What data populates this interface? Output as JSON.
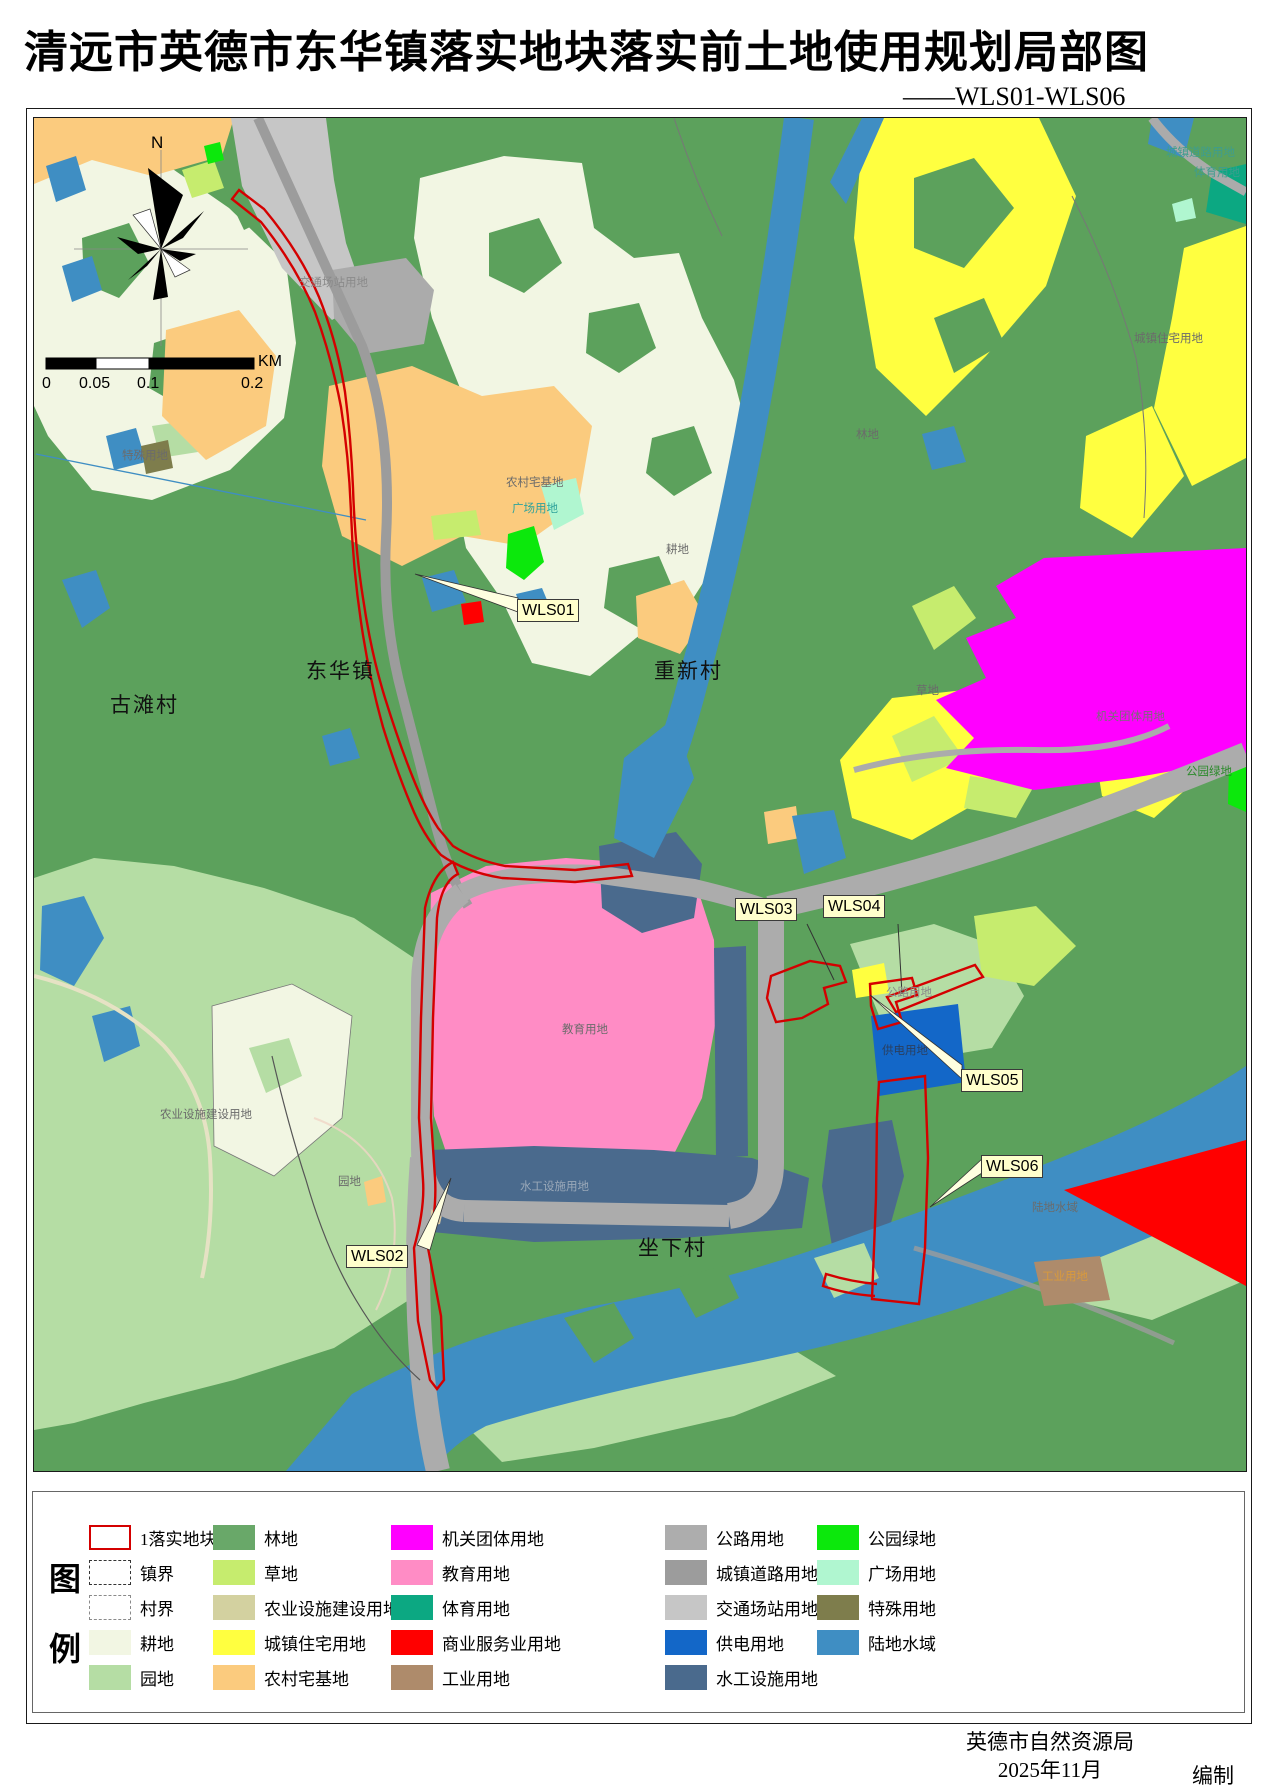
{
  "title": "清远市英德市东华镇落实地块落实前土地使用规划局部图",
  "subtitle": "——WLS01-WLS06",
  "compass": {
    "north": "N"
  },
  "scalebar": {
    "ticks": [
      "0",
      "0.05",
      "0.1",
      "0.2"
    ],
    "unit": "KM"
  },
  "map": {
    "places": [
      {
        "name": "东华镇"
      },
      {
        "name": "重新村"
      },
      {
        "name": "古滩村"
      },
      {
        "name": "坐下村"
      }
    ],
    "landuse_labels": [
      {
        "text": "交通场站用地"
      },
      {
        "text": "城镇道路用地"
      },
      {
        "text": "体育用地"
      },
      {
        "text": "城镇住宅用地"
      },
      {
        "text": "林地"
      },
      {
        "text": "特殊用地"
      },
      {
        "text": "农村宅基地"
      },
      {
        "text": "广场用地"
      },
      {
        "text": "耕地"
      },
      {
        "text": "草地"
      },
      {
        "text": "机关团体用地"
      },
      {
        "text": "公园绿地"
      },
      {
        "text": "公路用地"
      },
      {
        "text": "供电用地"
      },
      {
        "text": "教育用地"
      },
      {
        "text": "农业设施建设用地"
      },
      {
        "text": "园地"
      },
      {
        "text": "水工设施用地"
      },
      {
        "text": "陆地水域"
      },
      {
        "text": "工业用地"
      }
    ],
    "parcel_labels": [
      {
        "text": "WLS01"
      },
      {
        "text": "WLS02"
      },
      {
        "text": "WLS03"
      },
      {
        "text": "WLS04"
      },
      {
        "text": "WLS05"
      },
      {
        "text": "WLS06"
      }
    ]
  },
  "legend": {
    "heading": {
      "line1": "图",
      "line2": "例"
    },
    "col1": [
      {
        "label": "1落实地块",
        "type": "parcel-outline"
      },
      {
        "label": "镇界",
        "type": "town-boundary"
      },
      {
        "label": "村界",
        "type": "village-boundary"
      },
      {
        "label": "耕地",
        "color": "#F2F6E3"
      },
      {
        "label": "园地",
        "color": "#B5DDA4"
      }
    ],
    "col2": [
      {
        "label": "林地",
        "color": "#69A869"
      },
      {
        "label": "草地",
        "color": "#C6EC6E"
      },
      {
        "label": "农业设施建设用地",
        "color": "#D3D1A0"
      },
      {
        "label": "城镇住宅用地",
        "color": "#FFFF40"
      },
      {
        "label": "农村宅基地",
        "color": "#FBCB7E"
      }
    ],
    "col3": [
      {
        "label": "机关团体用地",
        "color": "#FF00FF"
      },
      {
        "label": "教育用地",
        "color": "#FF8CC5"
      },
      {
        "label": "体育用地",
        "color": "#0CA882"
      },
      {
        "label": "商业服务业用地",
        "color": "#FF0000"
      },
      {
        "label": "工业用地",
        "color": "#AE8B6B"
      }
    ],
    "col4": [
      {
        "label": "公路用地",
        "color": "#ADADAD"
      },
      {
        "label": "城镇道路用地",
        "color": "#9C9C9C"
      },
      {
        "label": "交通场站用地",
        "color": "#C6C6C6"
      },
      {
        "label": "供电用地",
        "color": "#1367C8"
      },
      {
        "label": "水工设施用地",
        "color": "#4A6A8D"
      }
    ],
    "col5": [
      {
        "label": "公园绿地",
        "color": "#0CE80C"
      },
      {
        "label": "广场用地",
        "color": "#B0F6D0"
      },
      {
        "label": "特殊用地",
        "color": "#7E7D4C"
      },
      {
        "label": "陆地水域",
        "color": "#3F8EC3"
      }
    ]
  },
  "footer": {
    "agency": "英德市自然资源局",
    "date": "2025年11月",
    "role": "编制"
  },
  "colors": {
    "parcel_outline": "#D40000",
    "forest_base": "#5CA15C"
  }
}
